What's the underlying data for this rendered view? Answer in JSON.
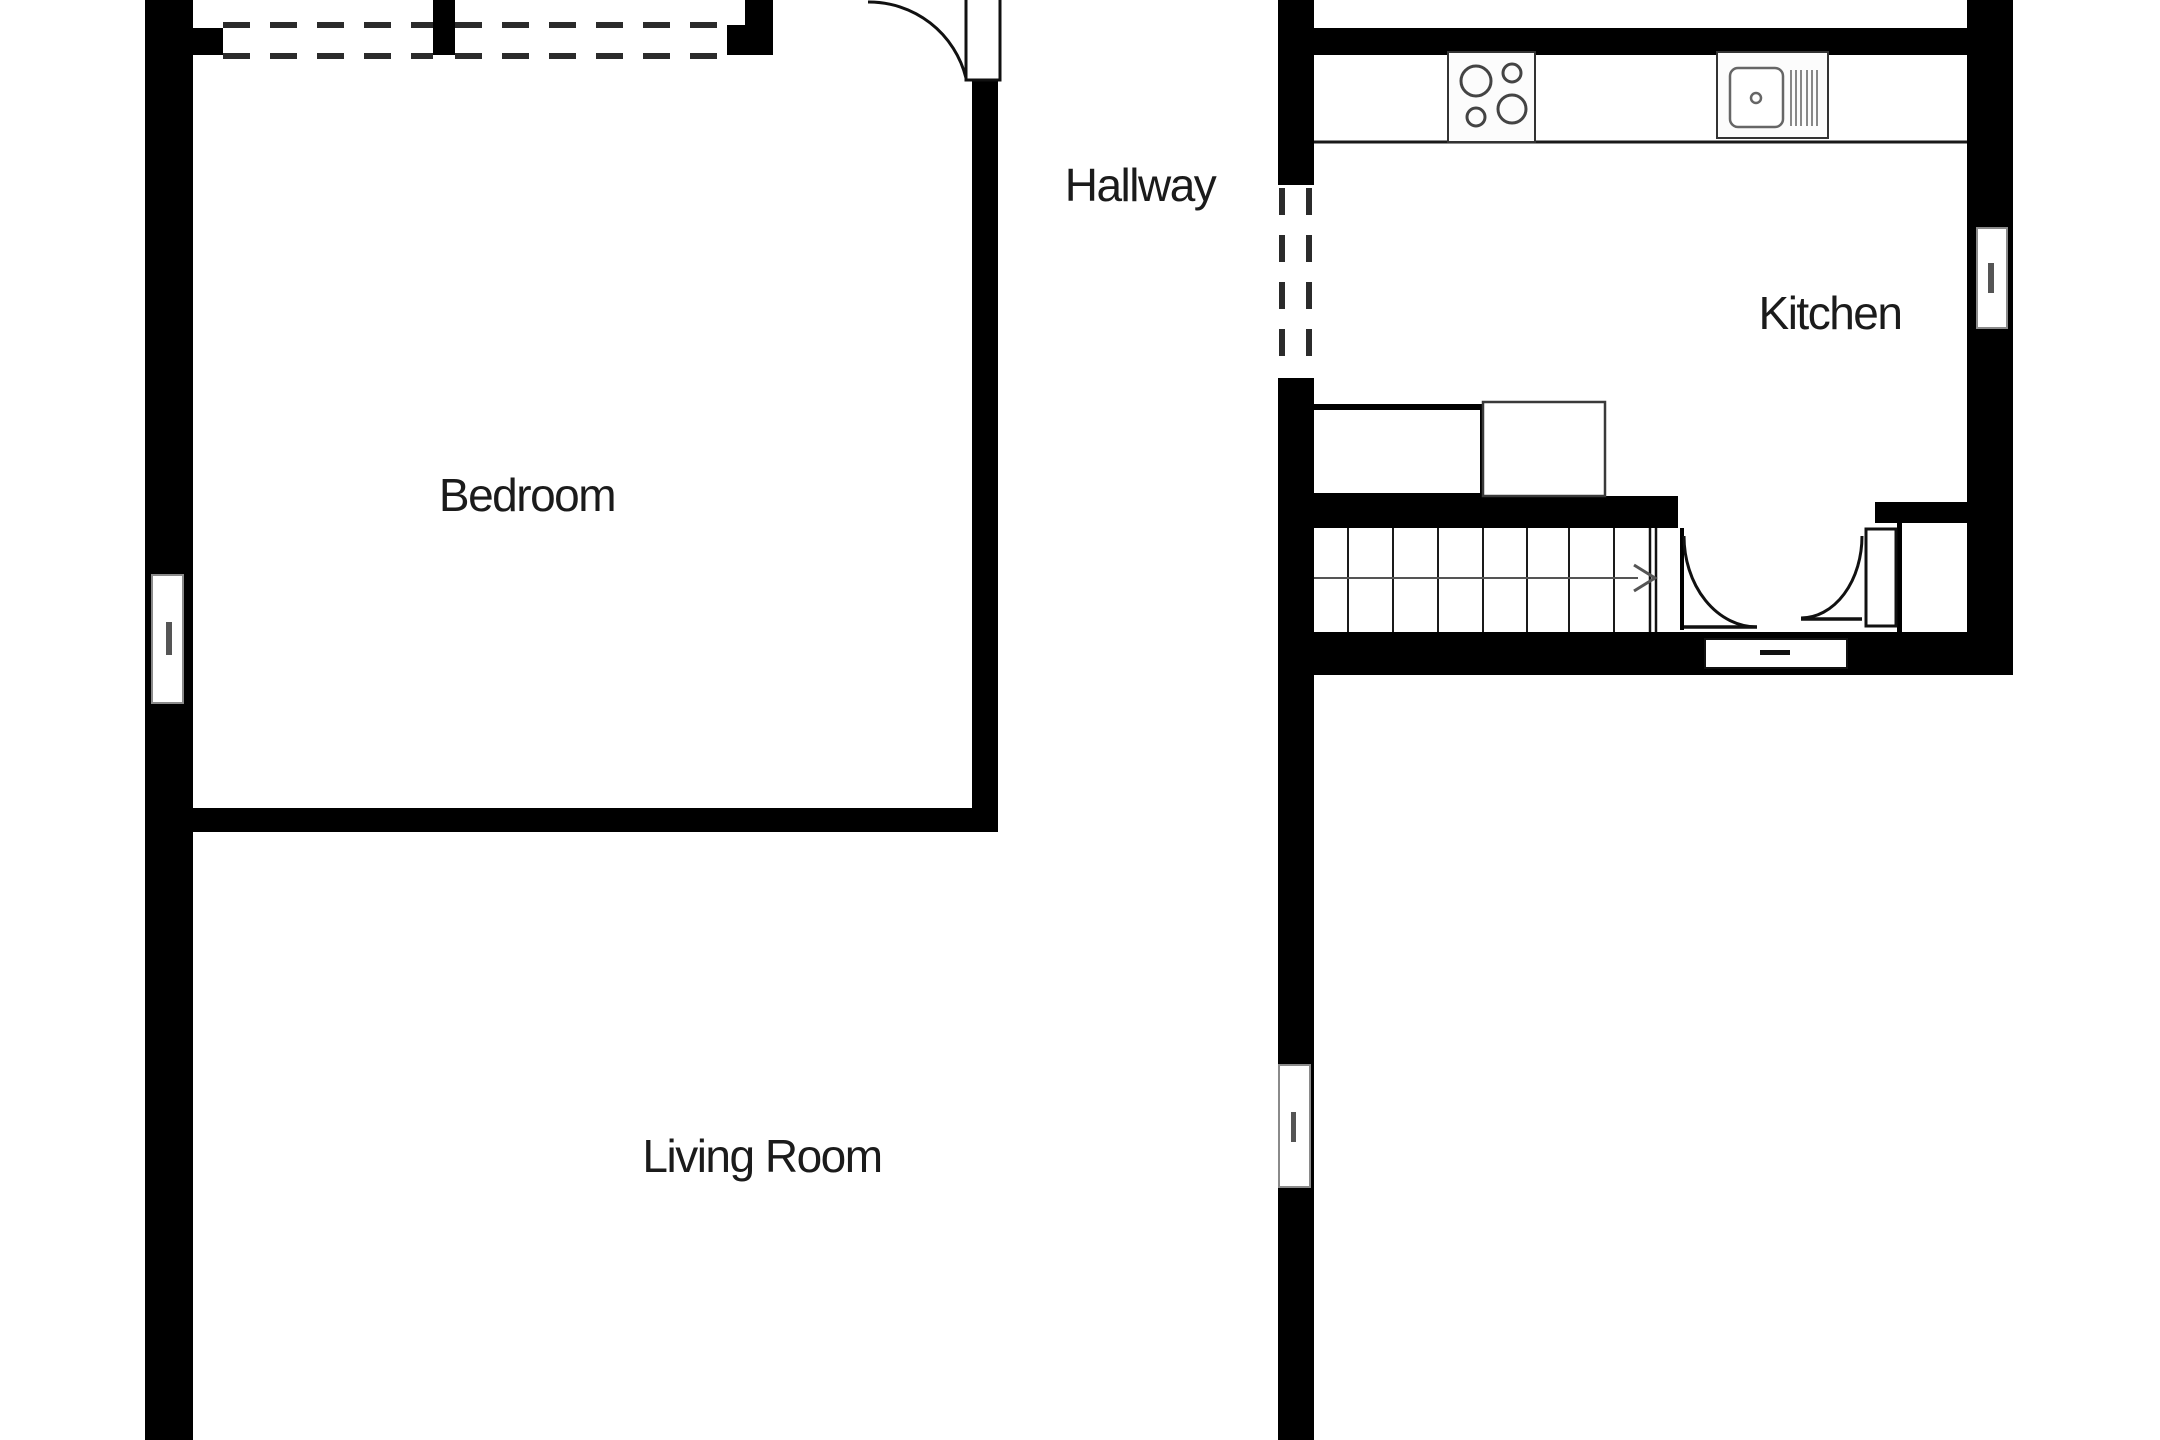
{
  "plan": {
    "background_color": "#ffffff",
    "wall_color": "#000000",
    "detail_color": "#555555",
    "rooms": {
      "bedroom": {
        "label": "Bedroom"
      },
      "hallway": {
        "label": "Hallway"
      },
      "kitchen": {
        "label": "Kitchen"
      },
      "living_room": {
        "label": "Living Room"
      }
    },
    "fixtures": {
      "stove": "4-burner hob",
      "sink": "sink with drainer",
      "staircase": "staircase with up arrow"
    }
  }
}
